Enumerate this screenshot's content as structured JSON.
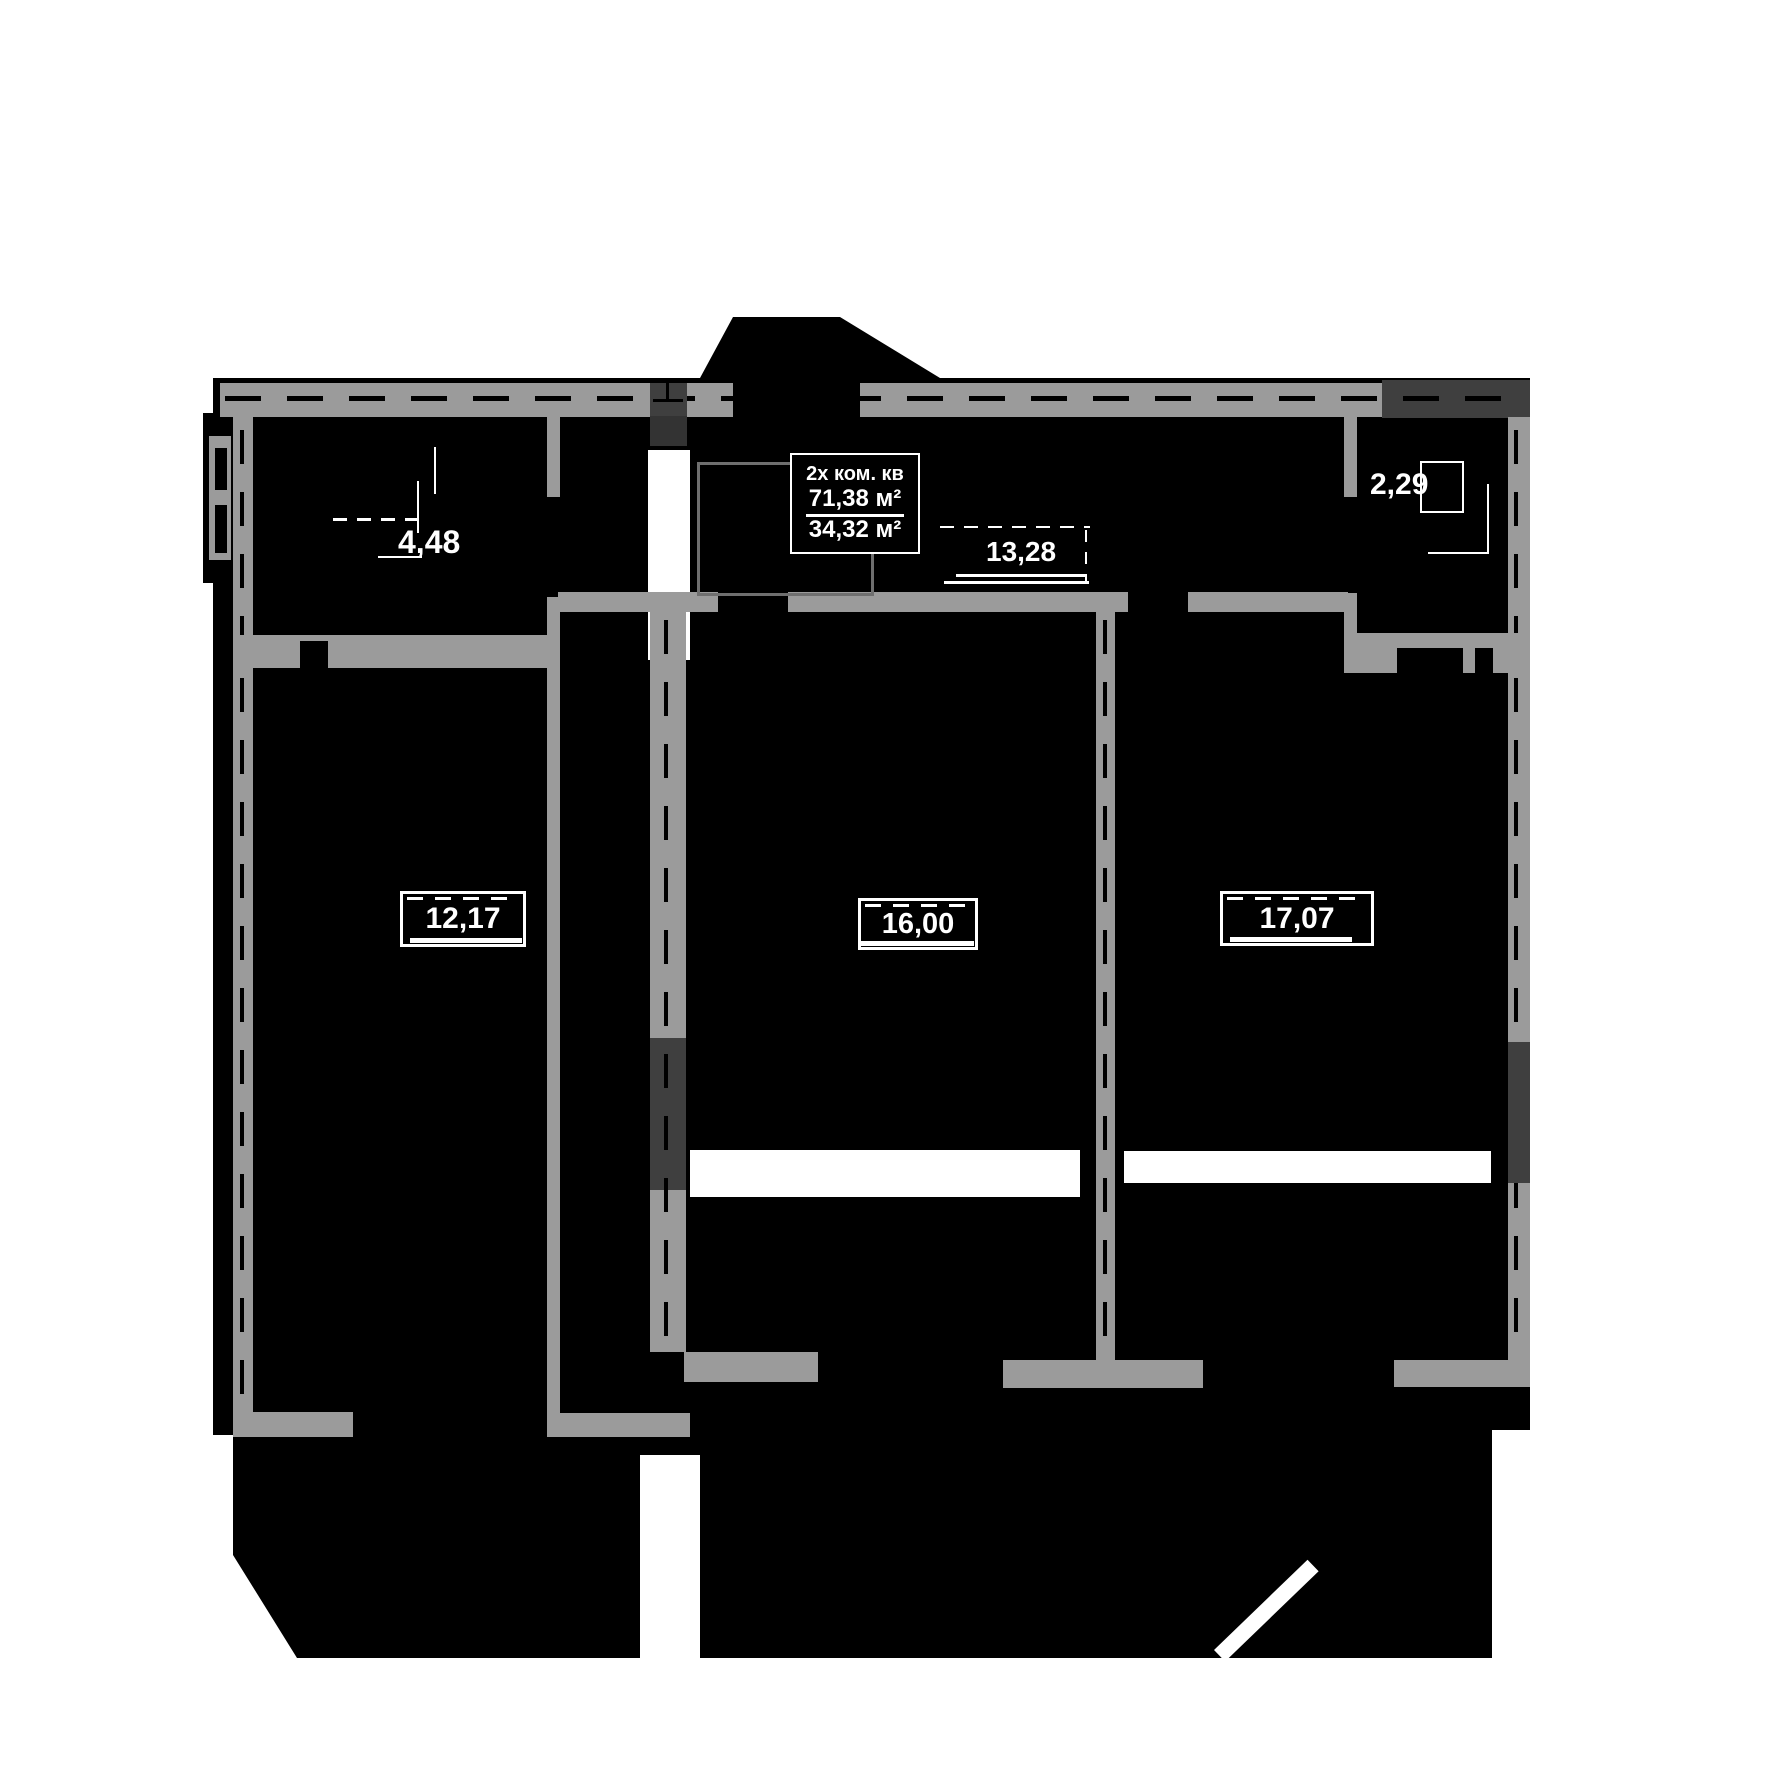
{
  "meta": {
    "kind": "apartment floor plan",
    "colors": {
      "background": "#ffffff",
      "plan_fill": "#000000",
      "wall": "#9b9b9b",
      "wall_dark": "#3f3f3f",
      "line_and_text": "#ffffff"
    }
  },
  "title_block": {
    "title": "2х ком. кв",
    "total_area": "71,38 м²",
    "living_area": "34,32 м²"
  },
  "rooms": [
    {
      "id": "top-left-room",
      "area": "4,48"
    },
    {
      "id": "hallway",
      "area": "13,28"
    },
    {
      "id": "balcony",
      "area": "2,29"
    },
    {
      "id": "left-room",
      "area": "12,17"
    },
    {
      "id": "middle-room",
      "area": "16,00"
    },
    {
      "id": "right-room",
      "area": "17,07"
    }
  ]
}
